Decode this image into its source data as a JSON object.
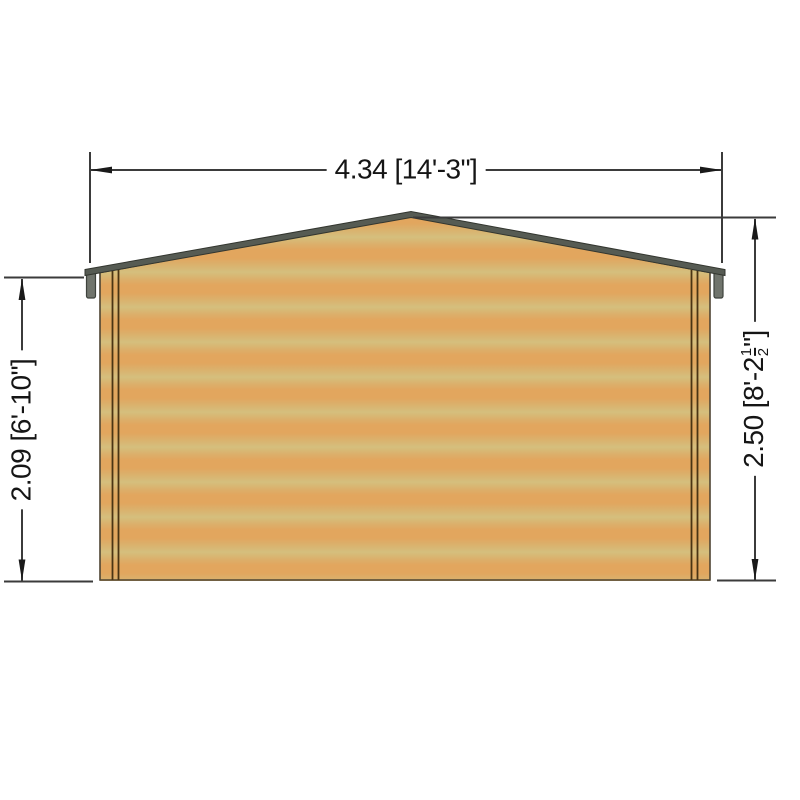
{
  "drawing": {
    "labels": {
      "width": "4.34 [14'-3\"]",
      "eaves_height": "2.09 [6'-10\"]",
      "ridge_height": {
        "metric": "2.50",
        "imperial_open": "[8'-2",
        "frac_num": "1",
        "frac_den": "2",
        "imperial_close": "\"]"
      }
    },
    "colors": {
      "background": "#ffffff",
      "wood_light": "#d5bf7d",
      "wood_orange": "#e2a65e",
      "roof_gray": "#565b53",
      "fascia_gray": "#70746c",
      "dimension_line": "#3b3b3b",
      "wall_outline": "#4e4433",
      "trim_line": "#4a3413",
      "text": "#151515"
    }
  }
}
